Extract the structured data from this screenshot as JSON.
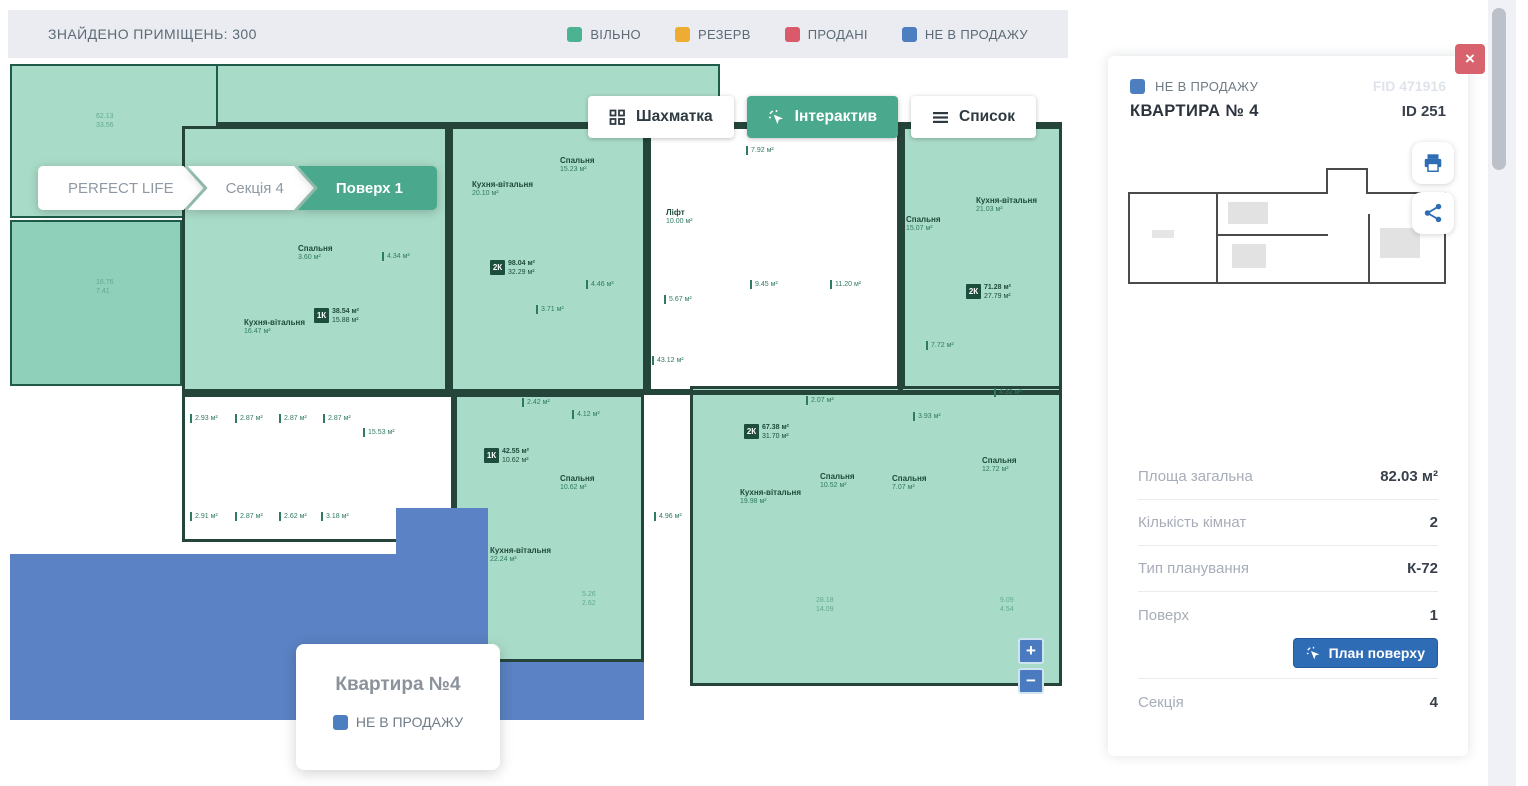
{
  "top_bar": {
    "found": "ЗНАЙДЕНО ПРИМІЩЕНЬ: 300",
    "legend": [
      {
        "label": "ВІЛЬНО",
        "color": "#4cb292"
      },
      {
        "label": "РЕЗЕРВ",
        "color": "#efac33"
      },
      {
        "label": "ПРОДАНІ",
        "color": "#da5a6b"
      },
      {
        "label": "НЕ В ПРОДАЖУ",
        "color": "#4d7ec0"
      }
    ]
  },
  "breadcrumb": [
    {
      "label": "PERFECT LIFE",
      "active": false
    },
    {
      "label": "Секція 4",
      "active": false
    },
    {
      "label": "Поверх 1",
      "active": true
    }
  ],
  "view_tabs": [
    {
      "label": "Шахматка",
      "icon": "grid-icon",
      "active": false
    },
    {
      "label": "Інтерактив",
      "icon": "cursor-icon",
      "active": true
    },
    {
      "label": "Список",
      "icon": "list-icon",
      "active": false
    }
  ],
  "tooltip": {
    "title": "Квартира №4",
    "status": "НЕ В ПРОДАЖУ",
    "status_color": "#4d7ec0"
  },
  "map": {
    "zoom_in": "+",
    "zoom_out": "−"
  },
  "panel": {
    "status": "НЕ В ПРОДАЖУ",
    "status_color": "#4d7ec0",
    "fid": "FID 471916",
    "title": "КВАРТИРА № 4",
    "id": "ID 251",
    "rows": [
      {
        "label": "Площа загальна",
        "value": "82.03 м²"
      },
      {
        "label": "Кількість кімнат",
        "value": "2"
      },
      {
        "label": "Тип планування",
        "value": "К-72"
      },
      {
        "label": "Поверх",
        "value": "1"
      }
    ],
    "floor_plan_button": "План поверху",
    "section": {
      "label": "Секція",
      "value": "4"
    },
    "close_label": "×"
  },
  "plan": {
    "colors": {
      "g": "#a9dcc8",
      "gd": "#8fd0ba",
      "w": "#ffffff",
      "b": "#5b82c4",
      "k": "#25453a"
    },
    "rects": [
      {
        "x": 2,
        "y": 4,
        "w": 208,
        "h": 154,
        "f": "g",
        "cls": "zone",
        "name": "plan-area-topleft",
        "click": true
      },
      {
        "x": 208,
        "y": 4,
        "w": 504,
        "h": 62,
        "f": "g",
        "cls": "zone",
        "name": "plan-area-topband",
        "click": true
      },
      {
        "x": 2,
        "y": 160,
        "w": 172,
        "h": 166,
        "f": "gd",
        "cls": "zone",
        "name": "plan-area-left",
        "click": true
      },
      {
        "x": 174,
        "y": 66,
        "w": 266,
        "h": 266,
        "f": "g",
        "cls": "apt",
        "name": "plan-apartment-1k-a",
        "click": true
      },
      {
        "x": 442,
        "y": 66,
        "w": 196,
        "h": 266,
        "f": "g",
        "cls": "apt",
        "name": "plan-apartment-2k-a",
        "click": true
      },
      {
        "x": 640,
        "y": 66,
        "w": 252,
        "h": 266,
        "f": "w",
        "cls": "apt",
        "name": "plan-core-stairs",
        "click": false
      },
      {
        "x": 894,
        "y": 66,
        "w": 160,
        "h": 266,
        "f": "g",
        "cls": "apt",
        "name": "plan-apartment-2k-b",
        "click": true
      },
      {
        "x": 174,
        "y": 334,
        "w": 272,
        "h": 148,
        "f": "w",
        "cls": "apt",
        "name": "plan-storage-block",
        "click": false
      },
      {
        "x": 446,
        "y": 334,
        "w": 190,
        "h": 268,
        "f": "g",
        "cls": "apt",
        "name": "plan-apartment-1k-b",
        "click": true
      },
      {
        "x": 682,
        "y": 326,
        "w": 372,
        "h": 300,
        "f": "g",
        "cls": "apt",
        "name": "plan-apartment-2k-c",
        "click": true
      },
      {
        "x": 2,
        "y": 494,
        "w": 478,
        "h": 166,
        "f": "b",
        "cls": "",
        "name": "plan-apartment-4-notforsale",
        "click": true
      },
      {
        "x": 388,
        "y": 448,
        "w": 92,
        "h": 212,
        "f": "b",
        "cls": "",
        "name": "plan-apartment-4-notforsale",
        "click": true
      },
      {
        "x": 446,
        "y": 602,
        "w": 190,
        "h": 58,
        "f": "b",
        "cls": "",
        "name": "plan-apartment-4-notforsale",
        "click": true
      },
      {
        "x": 208,
        "y": 62,
        "w": 846,
        "h": 5,
        "f": "k",
        "cls": "",
        "name": "plan-wall",
        "click": false
      },
      {
        "x": 438,
        "y": 66,
        "w": 5,
        "h": 266,
        "f": "k",
        "cls": "",
        "name": "plan-wall",
        "click": false
      },
      {
        "x": 636,
        "y": 66,
        "w": 5,
        "h": 266,
        "f": "k",
        "cls": "",
        "name": "plan-wall",
        "click": false
      },
      {
        "x": 890,
        "y": 66,
        "w": 5,
        "h": 266,
        "f": "k",
        "cls": "",
        "name": "plan-wall",
        "click": false
      },
      {
        "x": 174,
        "y": 330,
        "w": 880,
        "h": 5,
        "f": "k",
        "cls": "",
        "name": "plan-wall",
        "click": false
      }
    ],
    "labels": [
      {
        "x": 88,
        "y": 52,
        "l": [
          "62.13",
          "33.56"
        ],
        "c": "#63a98f"
      },
      {
        "x": 88,
        "y": 218,
        "l": [
          "16.76",
          "7.41"
        ],
        "c": "#63a98f"
      },
      {
        "x": 290,
        "y": 184,
        "l": [
          "Спальня",
          "3.60 м²"
        ],
        "b": true
      },
      {
        "x": 236,
        "y": 258,
        "l": [
          "Кухня-вітальня",
          "16.47 м²"
        ],
        "b": true
      },
      {
        "x": 374,
        "y": 192,
        "l": [
          "4.34 м²"
        ],
        "t": true
      },
      {
        "x": 464,
        "y": 120,
        "l": [
          "Кухня-вітальня",
          "20.10 м²"
        ],
        "b": true
      },
      {
        "x": 552,
        "y": 96,
        "l": [
          "Спальня",
          "15.23 м²"
        ],
        "b": true
      },
      {
        "x": 578,
        "y": 220,
        "l": [
          "4.46 м²"
        ],
        "t": true
      },
      {
        "x": 528,
        "y": 245,
        "l": [
          "3.71 м²"
        ],
        "t": true
      },
      {
        "x": 658,
        "y": 148,
        "l": [
          "Ліфт",
          "10.00 м²"
        ],
        "b": true
      },
      {
        "x": 738,
        "y": 86,
        "l": [
          "7.92 м²"
        ],
        "t": true
      },
      {
        "x": 742,
        "y": 220,
        "l": [
          "9.45 м²"
        ],
        "t": true
      },
      {
        "x": 656,
        "y": 235,
        "l": [
          "5.67 м²"
        ],
        "t": true
      },
      {
        "x": 822,
        "y": 220,
        "l": [
          "11.20 м²"
        ],
        "t": true
      },
      {
        "x": 644,
        "y": 296,
        "l": [
          "43.12 м²"
        ],
        "t": true
      },
      {
        "x": 968,
        "y": 136,
        "l": [
          "Кухня-вітальня",
          "21.03 м²"
        ],
        "b": true
      },
      {
        "x": 898,
        "y": 155,
        "l": [
          "Спальня",
          "15.07 м²"
        ],
        "b": true
      },
      {
        "x": 918,
        "y": 281,
        "l": [
          "7.72 м²"
        ],
        "t": true
      },
      {
        "x": 986,
        "y": 328,
        "l": [
          "4.32 м²"
        ],
        "t": true
      },
      {
        "x": 905,
        "y": 352,
        "l": [
          "3.93 м²"
        ],
        "t": true
      },
      {
        "x": 182,
        "y": 354,
        "l": [
          "2.93 м²"
        ],
        "t": true
      },
      {
        "x": 227,
        "y": 354,
        "l": [
          "2.87 м²"
        ],
        "t": true
      },
      {
        "x": 271,
        "y": 354,
        "l": [
          "2.87 м²"
        ],
        "t": true
      },
      {
        "x": 315,
        "y": 354,
        "l": [
          "2.87 м²"
        ],
        "t": true
      },
      {
        "x": 355,
        "y": 368,
        "l": [
          "15.53 м²"
        ],
        "t": true
      },
      {
        "x": 182,
        "y": 452,
        "l": [
          "2.91 м²"
        ],
        "t": true
      },
      {
        "x": 227,
        "y": 452,
        "l": [
          "2.87 м²"
        ],
        "t": true
      },
      {
        "x": 271,
        "y": 452,
        "l": [
          "2.62 м²"
        ],
        "t": true
      },
      {
        "x": 313,
        "y": 452,
        "l": [
          "3.18 м²"
        ],
        "t": true
      },
      {
        "x": 514,
        "y": 338,
        "l": [
          "2.42 м²"
        ],
        "t": true
      },
      {
        "x": 564,
        "y": 350,
        "l": [
          "4.12 м²"
        ],
        "t": true
      },
      {
        "x": 552,
        "y": 414,
        "l": [
          "Спальня",
          "10.62 м²"
        ],
        "b": true
      },
      {
        "x": 482,
        "y": 486,
        "l": [
          "Кухня-вітальня",
          "22.24 м²"
        ],
        "b": true
      },
      {
        "x": 574,
        "y": 530,
        "l": [
          "5.26",
          "2.62"
        ],
        "c": "#63a98f"
      },
      {
        "x": 646,
        "y": 452,
        "l": [
          "4.96 м²"
        ],
        "t": true
      },
      {
        "x": 798,
        "y": 336,
        "l": [
          "2.07 м²"
        ],
        "t": true
      },
      {
        "x": 732,
        "y": 428,
        "l": [
          "Кухня-вітальня",
          "19.98 м²"
        ],
        "b": true
      },
      {
        "x": 812,
        "y": 412,
        "l": [
          "Спальня",
          "10.52 м²"
        ],
        "b": true
      },
      {
        "x": 884,
        "y": 414,
        "l": [
          "Спальня",
          "7.07 м²"
        ],
        "b": true
      },
      {
        "x": 974,
        "y": 396,
        "l": [
          "Спальня",
          "12.72 м²"
        ],
        "b": true
      },
      {
        "x": 808,
        "y": 536,
        "l": [
          "28.18",
          "14.09"
        ],
        "c": "#63a98f"
      },
      {
        "x": 992,
        "y": 536,
        "l": [
          "9.09",
          "4.54"
        ],
        "c": "#63a98f"
      }
    ],
    "badges": [
      {
        "x": 306,
        "y": 248,
        "k": "1К",
        "l1": "38.54 м²",
        "l2": "15.88 м²"
      },
      {
        "x": 482,
        "y": 200,
        "k": "2К",
        "l1": "98.04 м²",
        "l2": "32.29 м²"
      },
      {
        "x": 958,
        "y": 224,
        "k": "2К",
        "l1": "71.28 м²",
        "l2": "27.79 м²"
      },
      {
        "x": 476,
        "y": 388,
        "k": "1К",
        "l1": "42.55 м²",
        "l2": "10.62 м²"
      },
      {
        "x": 736,
        "y": 364,
        "k": "2К",
        "l1": "67.38 м²",
        "l2": "31.70 м²"
      }
    ]
  }
}
